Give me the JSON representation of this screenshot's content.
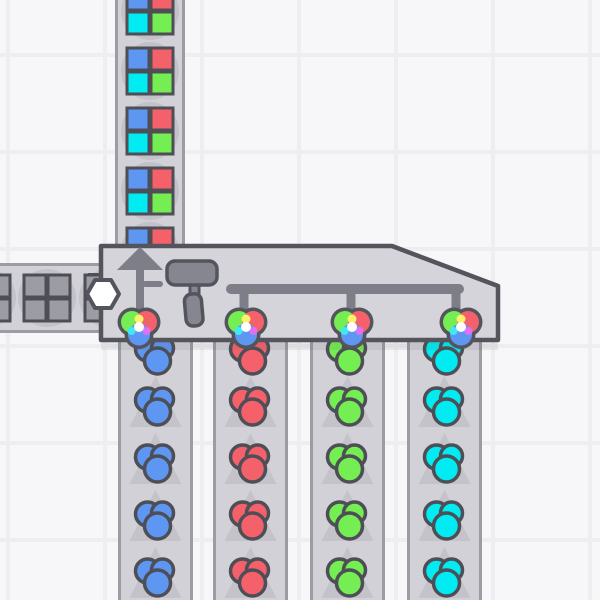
{
  "scene": {
    "kind": "factory-game-viewport",
    "building": {
      "type": "quad-painter",
      "icons": [
        "up-arrow-icon",
        "paint-roller-icon",
        "color-pipe-manifold"
      ],
      "shape_input_marker": "white-hexagon",
      "color_wheel_inputs": 4
    },
    "output_belt": {
      "direction": "up",
      "item": {
        "type": "window-shape",
        "quadrants": [
          "blue",
          "red",
          "cyan",
          "green"
        ]
      },
      "visible_items": 5
    },
    "shape_belt": {
      "direction": "right",
      "item": {
        "type": "window-shape",
        "quadrants": [
          "uncolored",
          "uncolored",
          "uncolored",
          "uncolored"
        ]
      },
      "visible_items": 3
    },
    "color_belts": [
      {
        "color": "blue",
        "direction": "up",
        "visible_items": 5
      },
      {
        "color": "red",
        "direction": "up",
        "visible_items": 5
      },
      {
        "color": "green",
        "direction": "up",
        "visible_items": 5
      },
      {
        "color": "cyan",
        "direction": "up",
        "visible_items": 5
      }
    ]
  },
  "palette": {
    "background": "#f7f7f9",
    "grid_line": "#eeeef1",
    "belt": "#d1d1d7",
    "belt_rail": "#9b9ca4",
    "belt_arrow": "#c3c3c9",
    "item_shadow": "#c2c2c8",
    "under_building_shadow": "rgba(84,85,93,0.10)",
    "building_fill": "#d4d4da",
    "building_border": "#53545c",
    "icon_gray": "#7d7e88",
    "icon_gray_light": "#85868f",
    "outline": "#4d4e56",
    "white": "#ffffff",
    "uncolored": "#9b9ca4",
    "blue": "#5e97f2",
    "red": "#f4616b",
    "green": "#74ee52",
    "cyan": "#00ecf2",
    "mix_yellow": "#f8f36a",
    "mix_magenta": "#df70f5",
    "mix_cyan": "#3fe9f0"
  }
}
